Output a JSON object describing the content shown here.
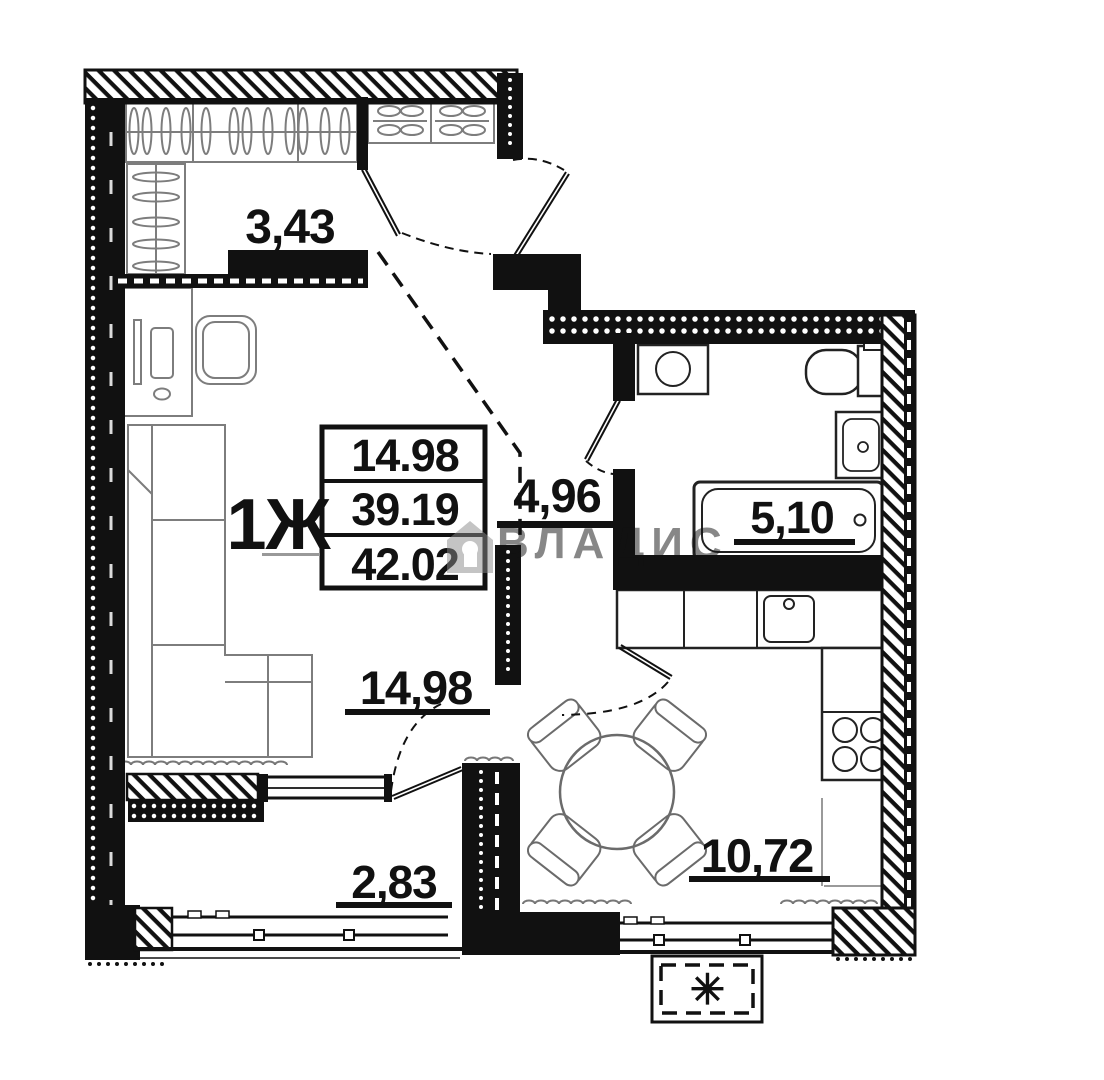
{
  "plan": {
    "apartment_type_label": "1Ж",
    "info_table": {
      "living_area": "14.98",
      "area": "39.19",
      "total_area": "42.02"
    },
    "rooms": {
      "wardrobe": "3,43",
      "hall": "4,96",
      "bathroom": "5,10",
      "living": "14,98",
      "kitchen": "10,72",
      "balcony": "2,83"
    },
    "watermark": "ВЛАДИС",
    "ac_unit_symbol": "✳"
  }
}
